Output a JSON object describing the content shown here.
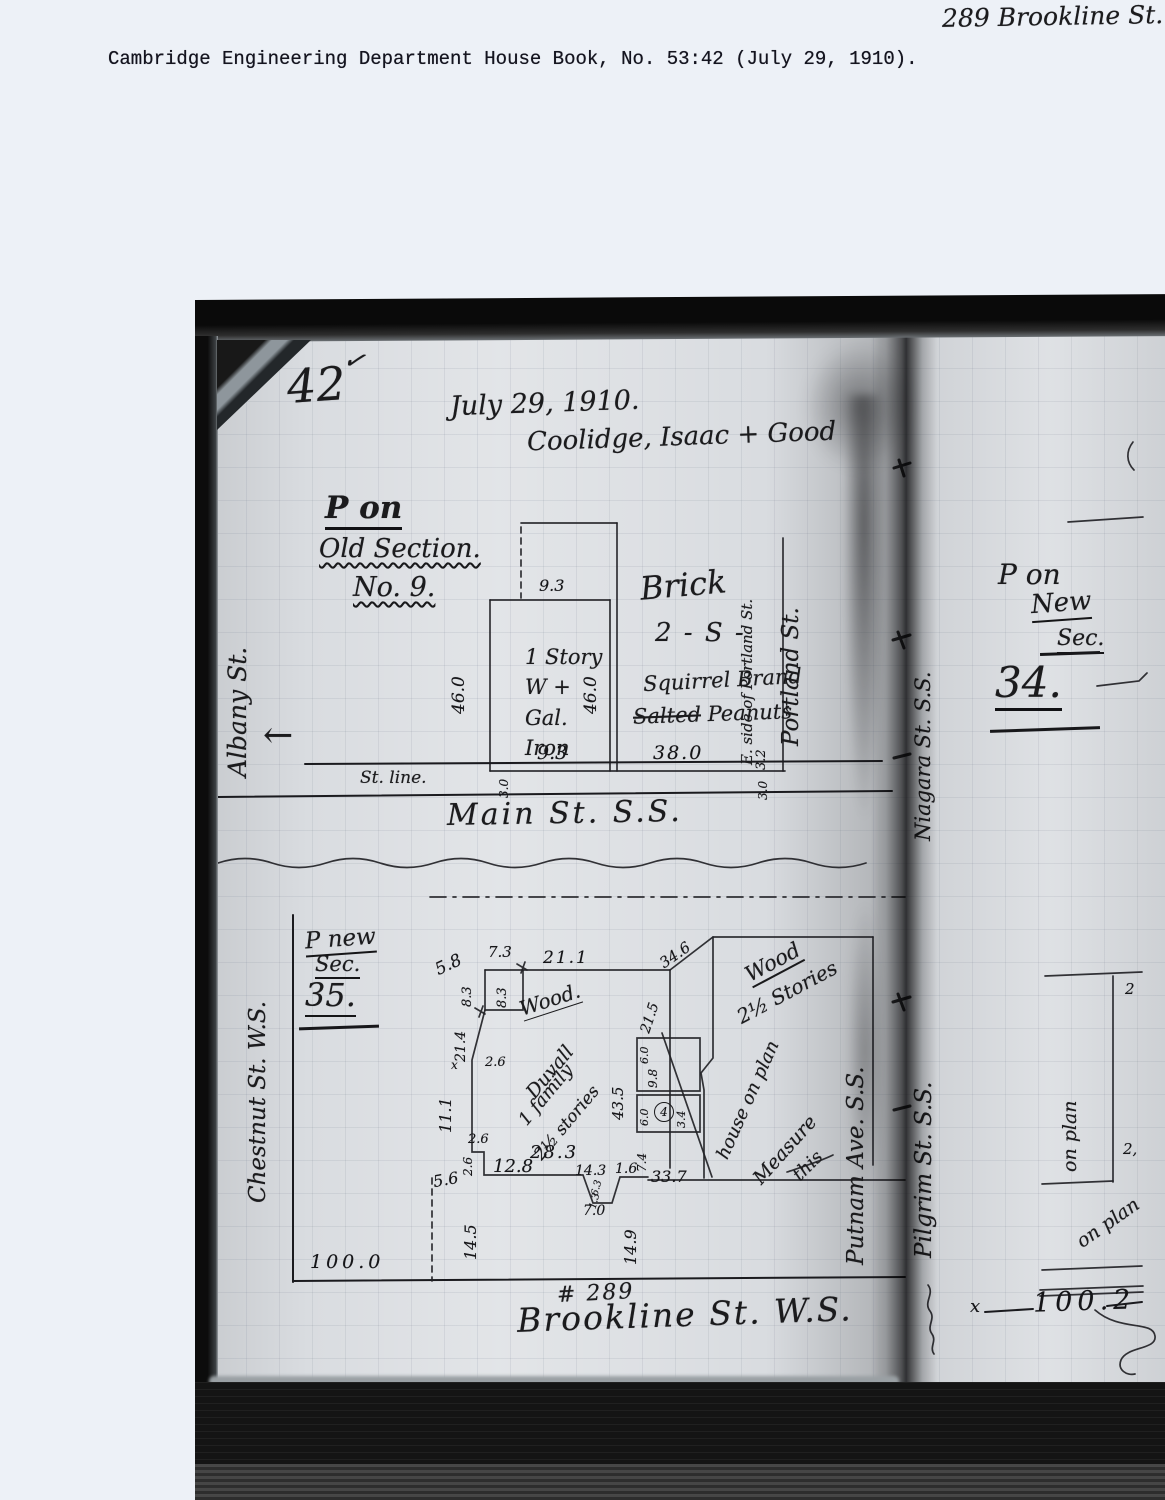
{
  "scan": {
    "corner_note": "289 Brookline St.",
    "caption": "Cambridge Engineering Department House Book, No. 53:42 (July 29, 1910)."
  },
  "book": {
    "page_number": "42",
    "checkmark": "✓",
    "date": "July 29, 1910.",
    "surveyors": "Coolidge, Isaac + Good",
    "upper": {
      "title1": "P on",
      "title2": "Old Section.",
      "title3": "No. 9.",
      "street_left": "Albany St.",
      "arrow": "←",
      "street_label": "St. line.",
      "street_bottom": "Main St.  S.S.",
      "bldg1": [
        "1 Story",
        "W +",
        "Gal.",
        "Iron"
      ],
      "bldg2_material": "Brick",
      "bldg2_stories": "2 - S -",
      "bldg2_sign1": "Squirrel Brand",
      "bldg2_sign_struck": "Salted",
      "bldg2_sign2": "Peanuts",
      "street_right": "Portland St.",
      "street_right_note": "E. side of Portland St.",
      "dims": {
        "w_top": "9.3",
        "w_bottom": "9.3",
        "depth_left": "46.0",
        "depth_right": "46.0",
        "w2_bottom": "38.0",
        "off1": "3.0",
        "off2": "3.2",
        "off3": "3.0"
      }
    },
    "right_upper": {
      "street_binding": "Niagara St. S.S.",
      "title1": "P on",
      "title2": "New",
      "title3": "Sec.",
      "title4": "34."
    },
    "lower": {
      "title1": "P new",
      "title2": "Sec.",
      "title3": "35.",
      "street_left": "Chestnut St. W.S.",
      "street_bottom": "Brookline St.  W.S.",
      "house_number": "# 289",
      "house_material": "Wood.",
      "house_owner": "Duvall",
      "house_family": "1 family",
      "house_stories": "2½ stories",
      "neighbor_material": "Wood",
      "neighbor_stories": "2½ Stories",
      "note1": "house on plan",
      "note2": "Measure",
      "note3": "this",
      "street_right1": "Putnam Ave. S.S.",
      "street_right2": "Pilgrim St. S.S.",
      "circled": "4",
      "x_mark": "x",
      "dims": {
        "d58": "5.8",
        "d73": "7.3",
        "d211": "21.1",
        "d346": "34.6",
        "d83a": "8.3",
        "d83b": "8.3",
        "d214": "21.4",
        "d215": "21.5",
        "d26a": "2.6",
        "d111": "11.1",
        "d26b": "2.6",
        "d26c": "2.6",
        "d56": "5.6",
        "d128": "12.8",
        "d283": "28.3",
        "d143": "14.3",
        "d16": "1.6",
        "d63": "6.3",
        "d13": "1.3",
        "d70": "7.0",
        "d145": "14.5",
        "d149": "14.9",
        "d100": "100.0",
        "d337": "33.7",
        "d435": "43.5",
        "d60a": "6.0",
        "d98": "9.8",
        "d60b": "6.0",
        "d34": "3.4",
        "d74": "7.4"
      }
    },
    "right_lower": {
      "on_plan1": "on plan",
      "on_plan2": "on plan",
      "mark2a": "2",
      "mark2b": "2,",
      "x_mark": "x",
      "frontage": "100.2"
    }
  }
}
